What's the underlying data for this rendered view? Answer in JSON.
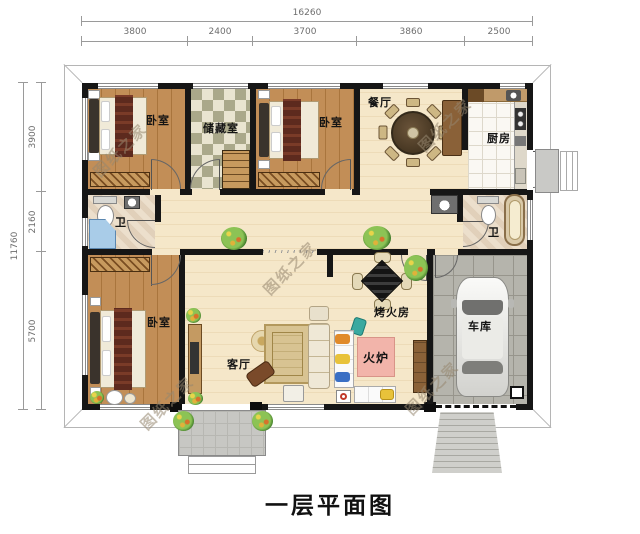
{
  "title": "一层平面图",
  "watermark_text": "图纸之家",
  "dimensions": {
    "top_total": "16260",
    "top_segments": [
      "3800",
      "2400",
      "3700",
      "3860",
      "2500"
    ],
    "left_total": "11760",
    "left_segments": [
      "3900",
      "2160",
      "5700"
    ]
  },
  "rooms": {
    "bedroom_top_left": "卧室",
    "storage": "储藏室",
    "bedroom_top_middle": "卧室",
    "dining": "餐厅",
    "kitchen": "厨房",
    "bath_left": "卫",
    "bath_right": "卫",
    "bedroom_bottom_left": "卧室",
    "living": "客厅",
    "fire_room": "烤火房",
    "stove": "火炉",
    "garage": "车库"
  },
  "colors": {
    "wall": "#161616",
    "wood_floor": "#bd8a52",
    "cream_floor": "#f5e7c9",
    "garage_floor": "#b5b4ac",
    "stove_pink": "#f2b4aa",
    "shower_blue": "#a9cce8"
  }
}
